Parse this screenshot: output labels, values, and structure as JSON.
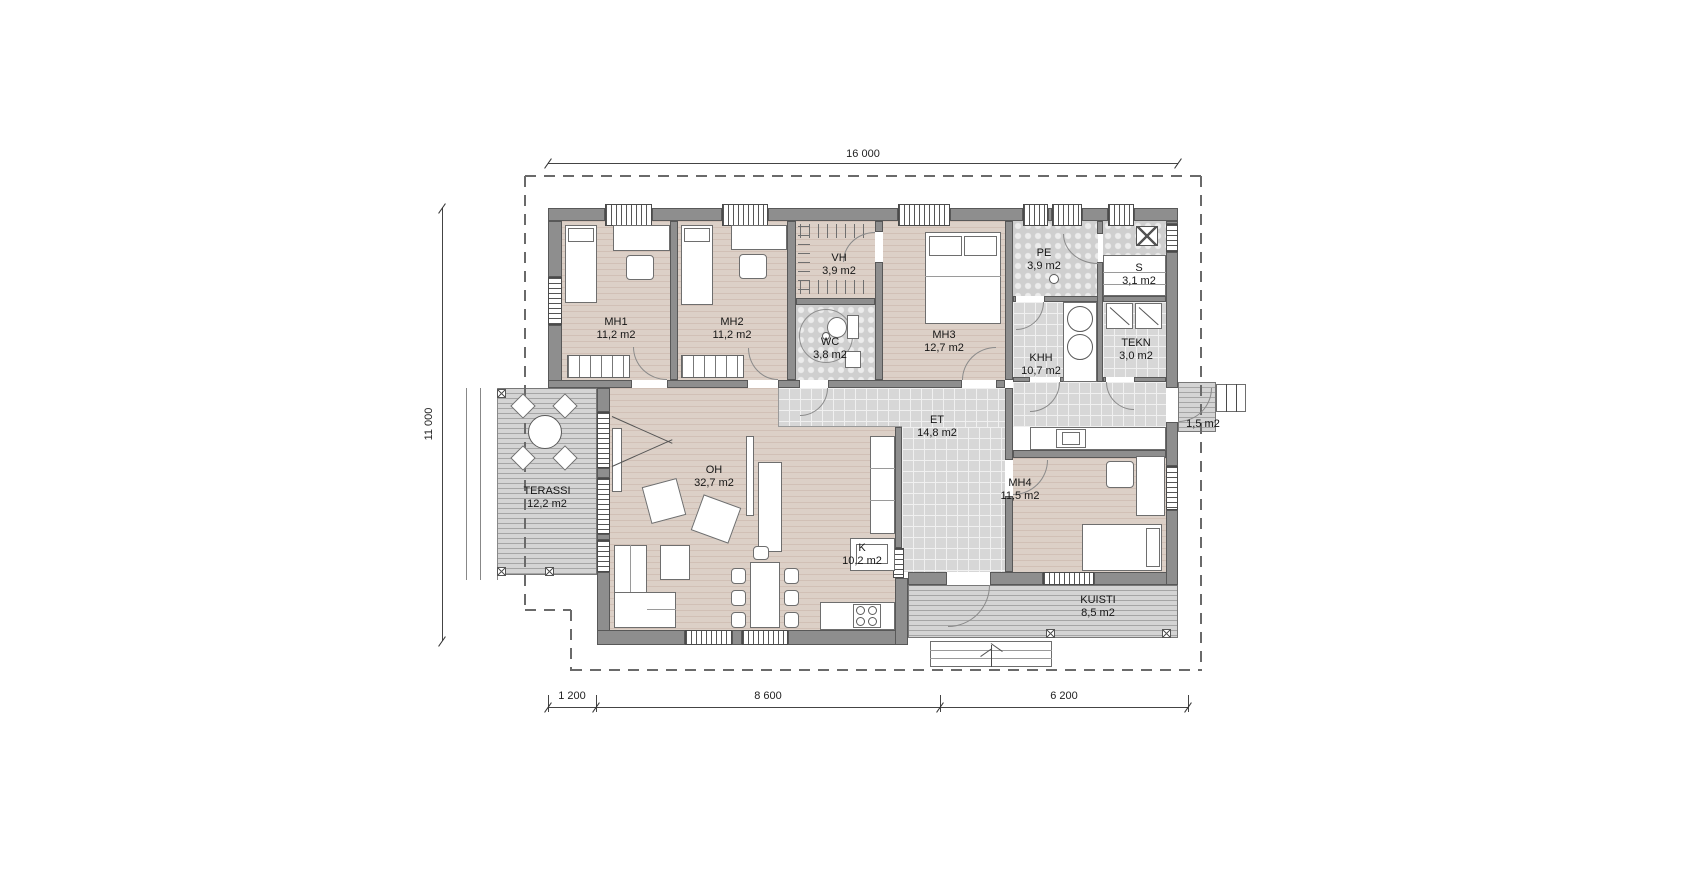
{
  "rooms": [
    {
      "id": "mh1",
      "name": "MH1",
      "area": "11,2 m2"
    },
    {
      "id": "mh2",
      "name": "MH2",
      "area": "11,2 m2"
    },
    {
      "id": "vh",
      "name": "VH",
      "area": "3,9 m2"
    },
    {
      "id": "wc",
      "name": "WC",
      "area": "3,8 m2"
    },
    {
      "id": "mh3",
      "name": "MH3",
      "area": "12,7 m2"
    },
    {
      "id": "pe",
      "name": "PE",
      "area": "3,9 m2"
    },
    {
      "id": "s",
      "name": "S",
      "area": "3,1 m2"
    },
    {
      "id": "khh",
      "name": "KHH",
      "area": "10,7 m2"
    },
    {
      "id": "tekn",
      "name": "TEKN",
      "area": "3,0 m2"
    },
    {
      "id": "et",
      "name": "ET",
      "area": "14,8 m2"
    },
    {
      "id": "oh",
      "name": "OH",
      "area": "32,7 m2"
    },
    {
      "id": "k",
      "name": "K",
      "area": "10,2 m2"
    },
    {
      "id": "mh4",
      "name": "MH4",
      "area": "11,5 m2"
    },
    {
      "id": "terassi",
      "name": "TERASSI",
      "area": "12,2 m2"
    },
    {
      "id": "kuisti",
      "name": "KUISTI",
      "area": "8,5 m2"
    }
  ],
  "stoop_area": "1,5 m2",
  "dimensions": {
    "top": "16 000",
    "left": "11 000",
    "bottom": [
      "1 200",
      "8 600",
      "6 200"
    ]
  },
  "colors": {
    "wall": "#8e8e8e",
    "wood_floor": "#dcd0c7",
    "tile_floor": "#d7d7d7",
    "wet_floor": "#d0d0d0",
    "deck": "#d4d4d4"
  }
}
